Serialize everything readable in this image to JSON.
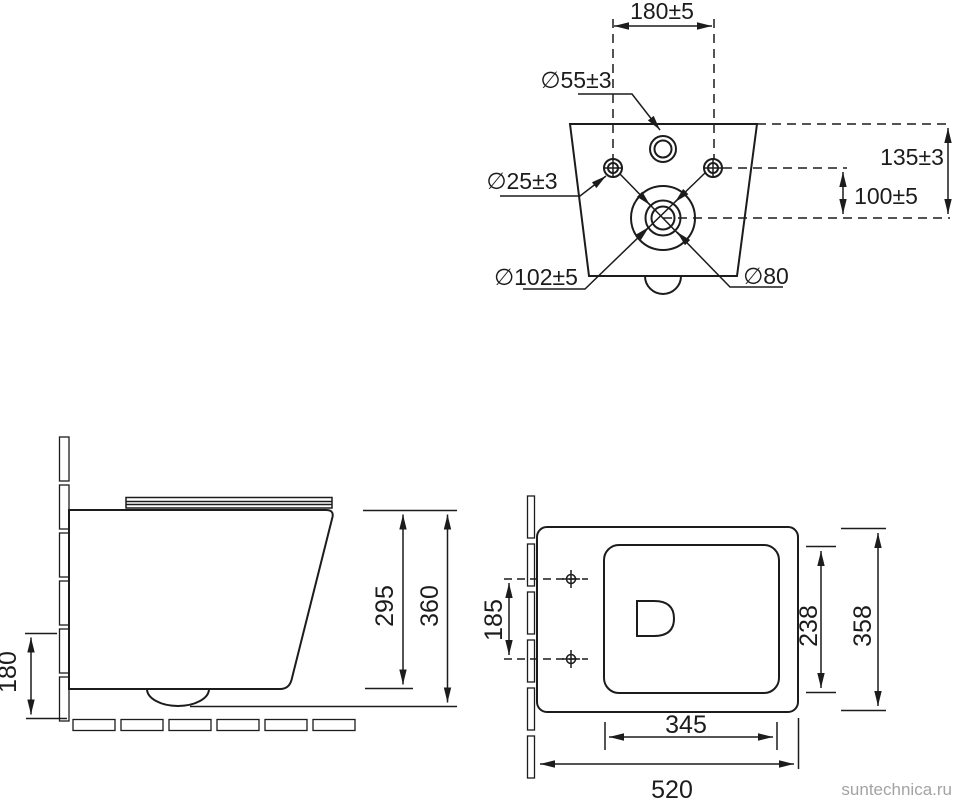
{
  "title": "wall-hung-toilet-dimension-drawing",
  "watermark": "suntechnica.ru",
  "colors": {
    "ink": "#1c1c1c",
    "watermark": "#a3a3a3",
    "background": "#ffffff"
  },
  "rear_view": {
    "hole_spacing": "180±5",
    "inlet_diameter": "∅55±3",
    "mount_hole_diameter": "∅25±3",
    "outlet_outer_diameter": "∅102±5",
    "outlet_inner_diameter": "∅80",
    "top_to_outlet_height": "135±3",
    "holes_to_outlet_height": "100±5"
  },
  "side_view": {
    "outlet_height": "180",
    "rim_height": "295",
    "overall_height": "360"
  },
  "plan_view": {
    "mount_hole_spacing": "185",
    "bowl_inner_width": "238",
    "overall_width": "358",
    "bowl_inner_length": "345",
    "overall_depth": "520"
  }
}
